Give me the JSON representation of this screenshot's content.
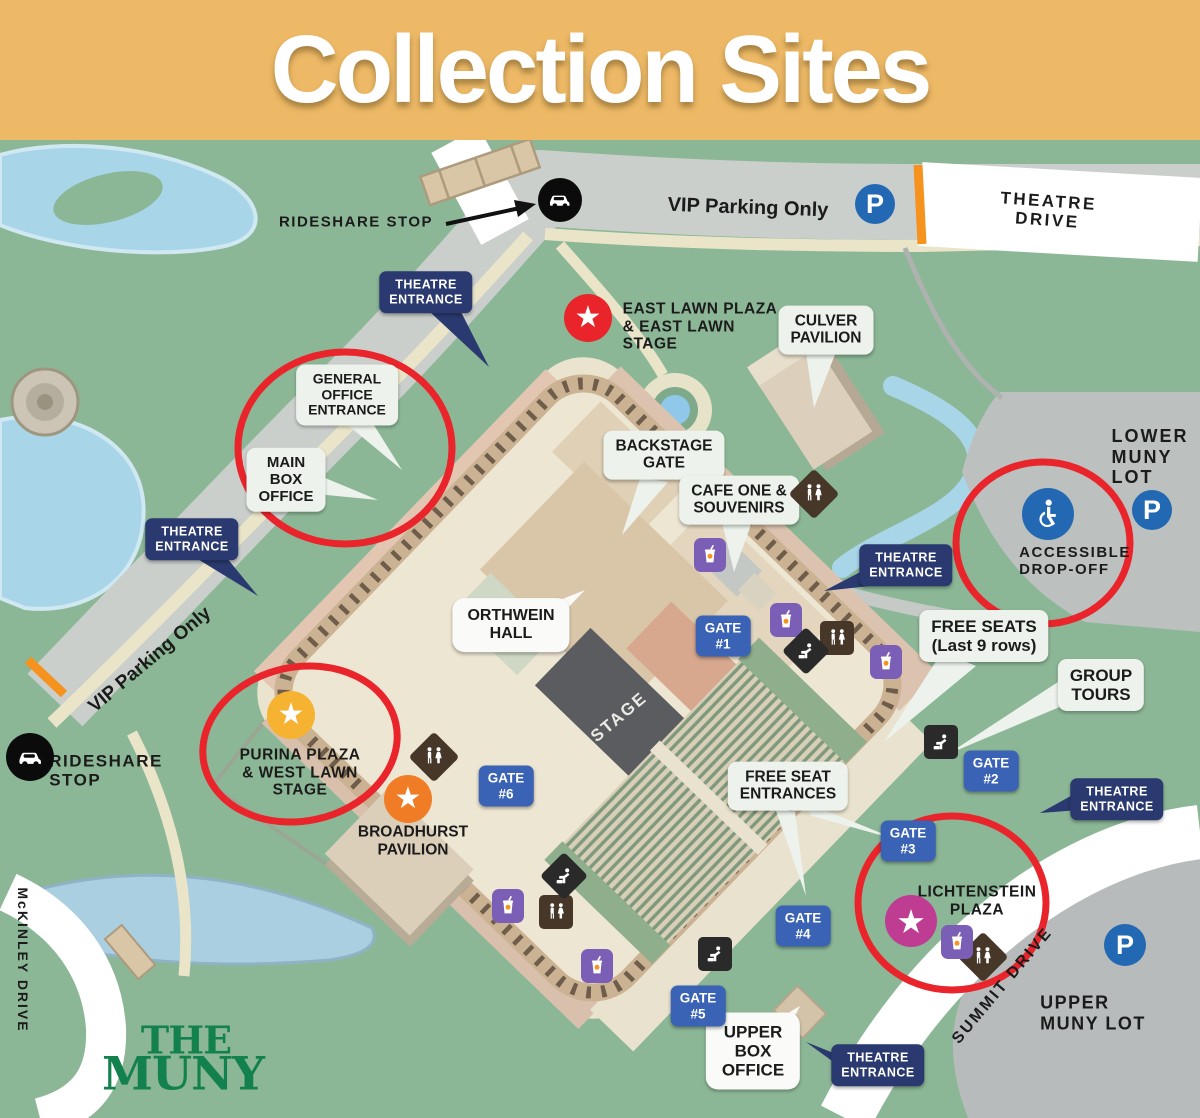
{
  "title": "Collection Sites",
  "logo": {
    "line1": "THE",
    "line2": "MUNY"
  },
  "labels": {
    "rideshare_top": "RIDESHARE STOP",
    "rideshare_left": "RIDESHARE\nSTOP",
    "vip_top": "VIP Parking Only",
    "vip_left": "VIP Parking Only",
    "theatre_drive": "THEATRE DRIVE",
    "summit_drive": "SUMMIT DRIVE",
    "mckinley_drive": "McKINLEY DRIVE",
    "theatre_entrance": "THEATRE\nENTRANCE",
    "lower_lot": "LOWER\nMUNY\nLOT",
    "upper_lot": "UPPER\nMUNY LOT",
    "accessible_dropoff": "ACCESSIBLE\nDROP-OFF",
    "east_lawn": "EAST LAWN PLAZA\n& EAST LAWN\nSTAGE",
    "purina": "PURINA PLAZA\n& WEST LAWN\nSTAGE",
    "broadhurst": "BROADHURST\nPAVILION",
    "lichtenstein": "LICHTENSTEIN\nPLAZA",
    "stage": "STAGE"
  },
  "bubbles": {
    "general_office": "GENERAL\nOFFICE\nENTRANCE",
    "main_box_office": "MAIN\nBOX\nOFFICE",
    "culver": "CULVER\nPAVILION",
    "backstage_gate": "BACKSTAGE\nGATE",
    "cafe_one": "CAFE ONE &\nSOUVENIRS",
    "orthwein": "ORTHWEIN\nHALL",
    "free_seats": "FREE SEATS\n(Last 9 rows)",
    "group_tours": "GROUP\nTOURS",
    "free_seat_entrances": "FREE SEAT\nENTRANCES",
    "upper_box_office": "UPPER\nBOX\nOFFICE"
  },
  "gates": {
    "g1": "GATE\n#1",
    "g2": "GATE\n#2",
    "g3": "GATE\n#3",
    "g4": "GATE\n#4",
    "g5": "GATE\n#5",
    "g6": "GATE\n#6"
  },
  "icons": {
    "parking_letter": "P",
    "star_glyph": "★",
    "rideshare": "car-icon",
    "accessible": "wheelchair-icon",
    "restroom": "restroom-icon",
    "drink": "concessions-icon",
    "fountain": "water-fountain-icon"
  },
  "colors": {
    "banner": "#EDB966",
    "map_green": "#8CB796",
    "highlight_red": "#E9242B",
    "navy_badge": "#2A3A70",
    "gate_blue": "#3A62B5",
    "parking_blue": "#2268B2",
    "east_lawn_star": "#E9242B",
    "purina_star": "#F6B331",
    "broadhurst_star": "#F07D26",
    "lichtenstein_star": "#BE3C92",
    "logo_green": "#12814E"
  }
}
